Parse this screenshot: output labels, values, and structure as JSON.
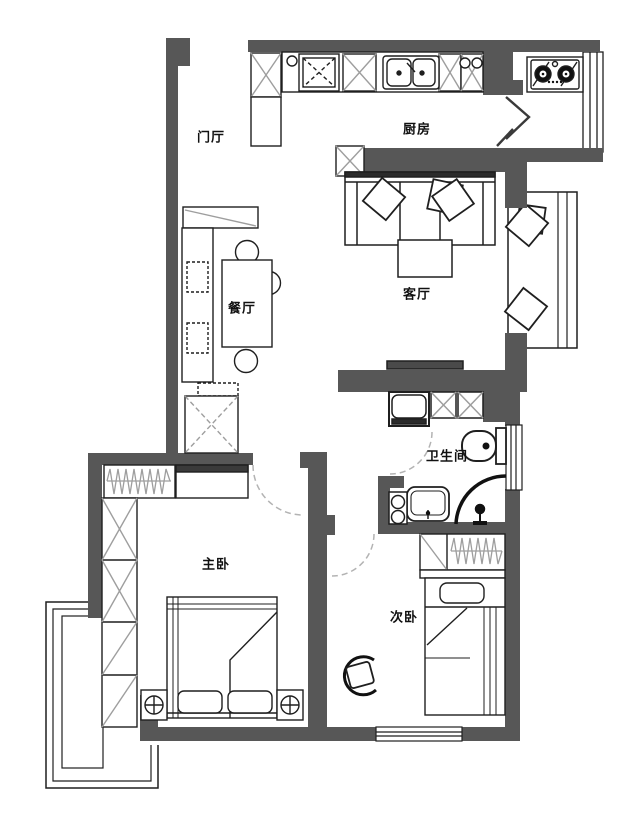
{
  "plan": {
    "type": "apartment-floor-plan",
    "rooms": [
      {
        "id": "entry",
        "label": "门厅",
        "furniture": [
          "shoe-cabinet"
        ]
      },
      {
        "id": "kitchen",
        "label": "厨房",
        "furniture": [
          "fridge-cabinet",
          "counter",
          "double-sink",
          "upper-cabinets",
          "gas-stove"
        ]
      },
      {
        "id": "dining",
        "label": "餐厅",
        "furniture": [
          "bench",
          "cushions",
          "dining-table",
          "chairs",
          "storage-closet"
        ]
      },
      {
        "id": "living",
        "label": "客厅",
        "furniture": [
          "sofa",
          "pillows",
          "coffee-table",
          "tv-console",
          "bay-window-seat"
        ]
      },
      {
        "id": "bathroom",
        "label": "卫生间",
        "furniture": [
          "washing-machine",
          "cabinets",
          "toilet",
          "wash-basin",
          "shower"
        ]
      },
      {
        "id": "master-bedroom",
        "label": "主卧",
        "furniture": [
          "wardrobe-column",
          "closet-rail",
          "double-bed",
          "nightstands",
          "bay-window"
        ]
      },
      {
        "id": "second-bedroom",
        "label": "次卧",
        "furniture": [
          "wardrobe-rail",
          "single-bed",
          "chair"
        ]
      }
    ],
    "colors": {
      "wall": "#575757",
      "line": "#1f1f1f",
      "accent_gray": "#9e9e9e",
      "door_arc": "#b3b3b3",
      "background": "#ffffff"
    }
  }
}
